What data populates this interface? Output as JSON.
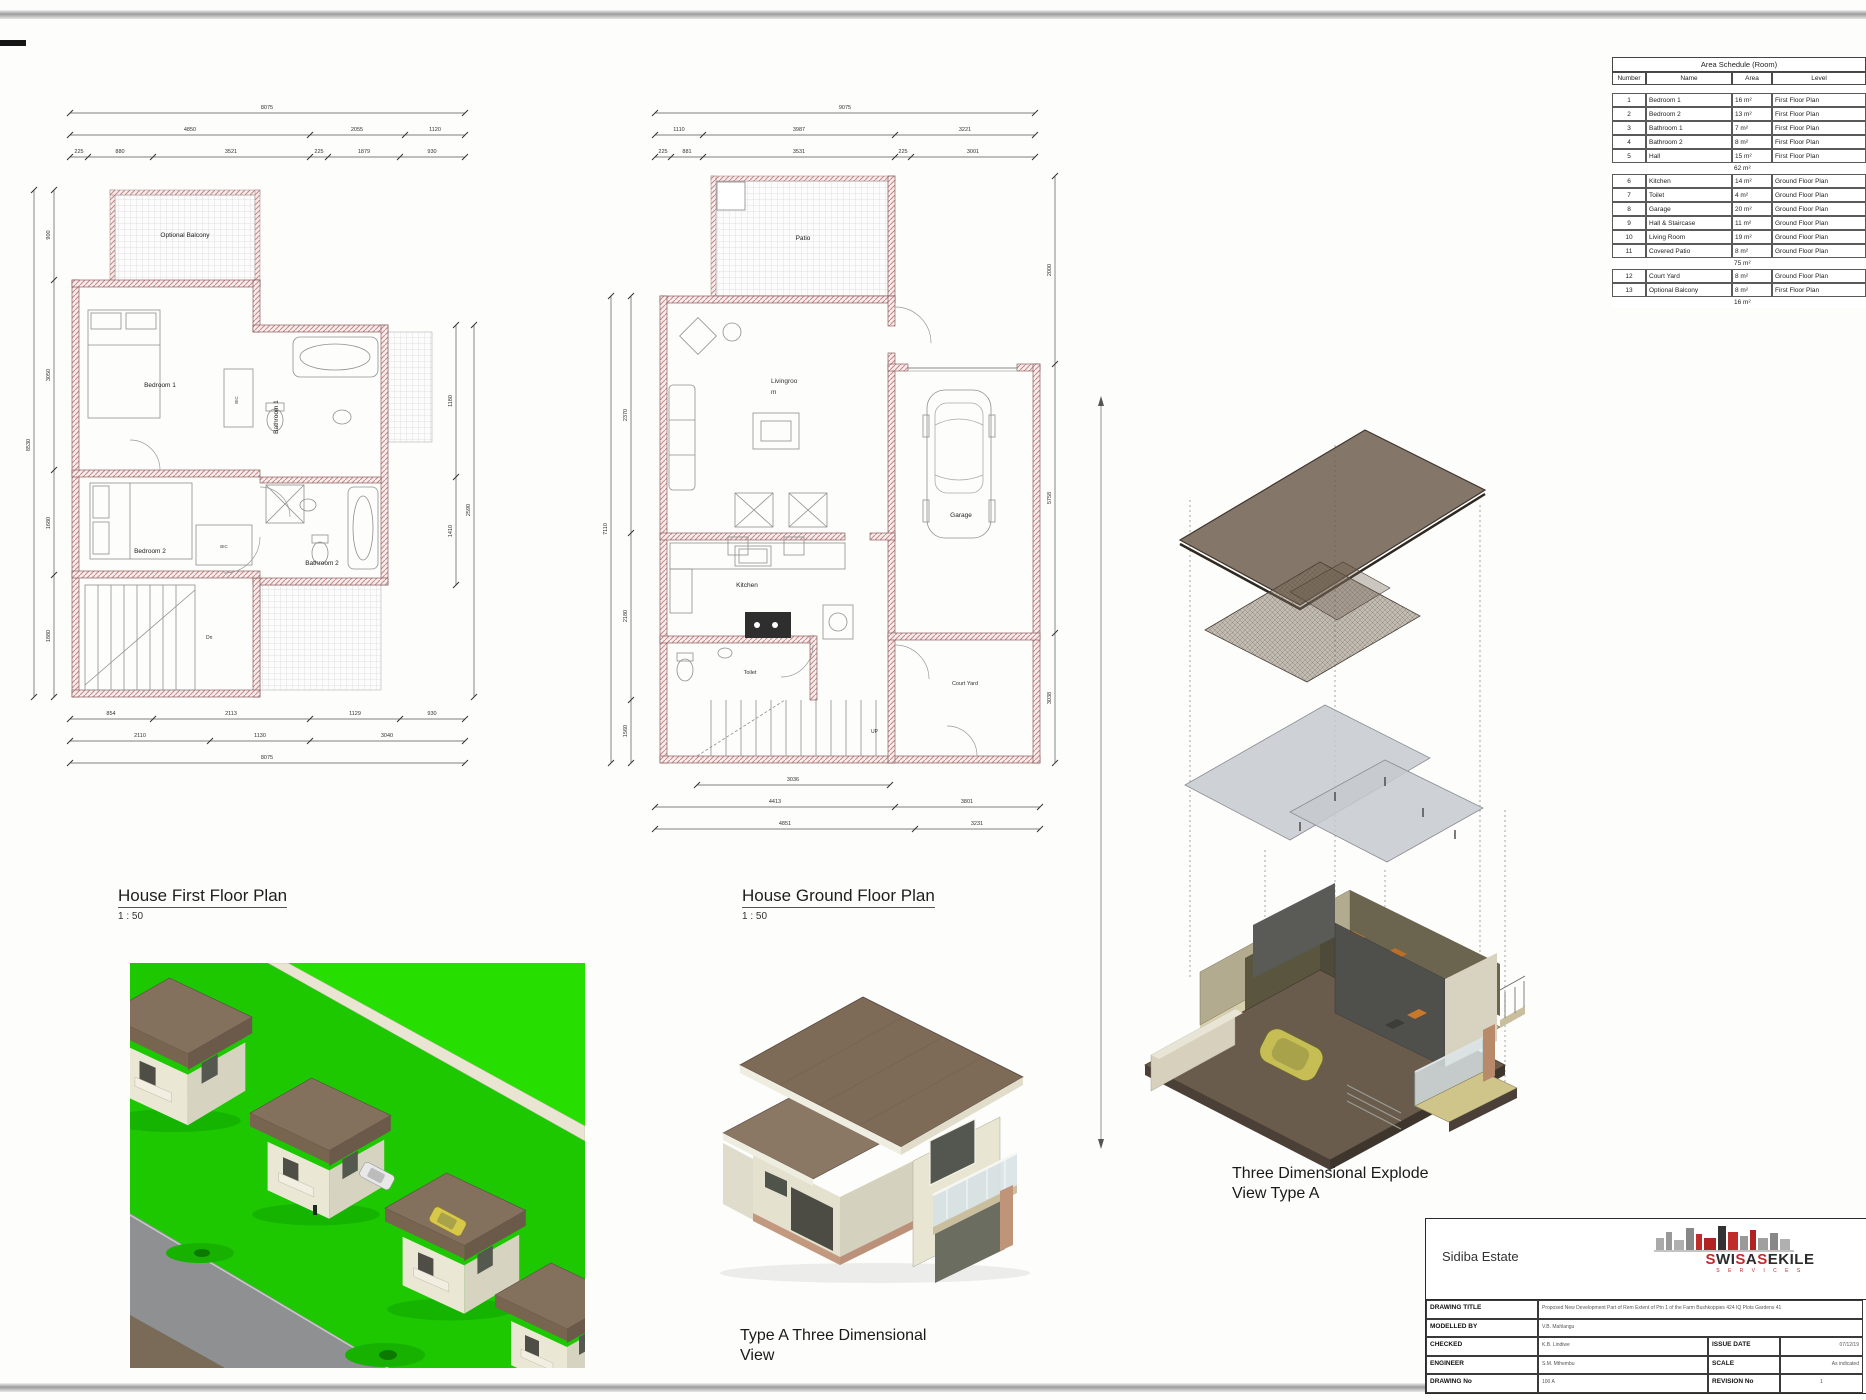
{
  "colors": {
    "logo_red": "#c02b2b",
    "logo_dark": "#2b2b2b",
    "grass_green": "#1ec800",
    "roof_brown": "#7d6b57",
    "wall_hatch_pink": "#c88a8a",
    "slab_gray": "#c6c9ce"
  },
  "area_schedule": {
    "title": "Area Schedule (Room)",
    "headers": [
      "Number",
      "Name",
      "Area",
      "Level"
    ],
    "rows": [
      {
        "no": "1",
        "name": "Bedroom 1",
        "area": "16 m²",
        "level": "First Floor Plan"
      },
      {
        "no": "2",
        "name": "Bedroom 2",
        "area": "13 m²",
        "level": "First Floor Plan"
      },
      {
        "no": "3",
        "name": "Bathroom 1",
        "area": "7 m²",
        "level": "First Floor Plan"
      },
      {
        "no": "4",
        "name": "Bathroom 2",
        "area": "8 m²",
        "level": "First Floor Plan"
      },
      {
        "no": "5",
        "name": "Hall",
        "area": "15 m²",
        "level": "First Floor Plan"
      },
      {
        "subtotal": "62 m²"
      },
      {
        "no": "6",
        "name": "Kitchen",
        "area": "14 m²",
        "level": "Ground Floor Plan"
      },
      {
        "no": "7",
        "name": "Toilet",
        "area": "4 m²",
        "level": "Ground Floor Plan"
      },
      {
        "no": "8",
        "name": "Garage",
        "area": "20 m²",
        "level": "Ground Floor Plan"
      },
      {
        "no": "9",
        "name": "Hall & Staircase",
        "area": "11 m²",
        "level": "Ground Floor Plan"
      },
      {
        "no": "10",
        "name": "Living Room",
        "area": "19 m²",
        "level": "Ground Floor Plan"
      },
      {
        "no": "11",
        "name": "Covered Patio",
        "area": "8 m²",
        "level": "Ground Floor Plan"
      },
      {
        "subtotal": "75 m²"
      },
      {
        "no": "12",
        "name": "Court Yard",
        "area": "8 m²",
        "level": "Ground Floor Plan"
      },
      {
        "no": "13",
        "name": "Optional Balcony",
        "area": "8 m²",
        "level": "First Floor Plan"
      },
      {
        "subtotal": "16 m²"
      }
    ]
  },
  "plans": {
    "first_floor": {
      "title": "House First Floor Plan",
      "scale": "1 : 50",
      "rooms": {
        "balcony": "Optional Balcony",
        "bedroom1": "Bedroom 1",
        "bathroom1": "Bathroom 1",
        "bedroom2": "Bedroom 2",
        "bathroom2": "Bathroom 2",
        "stairs_dn": "Dn",
        "bic": "BIC"
      },
      "dims": {
        "t1": [
          "8075"
        ],
        "t2": [
          "4850",
          "2055",
          "1120"
        ],
        "t3": [
          "225",
          "880",
          "3521",
          "225",
          "1879",
          "930"
        ],
        "b1": [
          "854",
          "2113",
          "1129",
          "930"
        ],
        "b2": [
          "2110",
          "1130",
          "3040"
        ],
        "b3": [
          "8075"
        ],
        "l1": [
          "8530"
        ],
        "l2": [
          "900",
          "3050",
          "1680",
          "1880"
        ],
        "r1": [
          "2590"
        ],
        "r2": [
          "1180",
          "1410"
        ]
      }
    },
    "ground_floor": {
      "title": "House Ground Floor Plan",
      "scale": "1 : 50",
      "rooms": {
        "patio": "Patio",
        "living_1": "Livingroo",
        "living_2": "m",
        "kitchen": "Kitchen",
        "toilet": "Toilet",
        "garage": "Garage",
        "court_yard": "Court Yard",
        "stairs_up": "UP"
      },
      "dims": {
        "t1": [
          "9075"
        ],
        "t2": [
          "1110",
          "3987",
          "3221"
        ],
        "t3": [
          "225",
          "881",
          "3531",
          "225",
          "3001"
        ],
        "b1": [
          "3036"
        ],
        "b2": [
          "4413",
          "3801"
        ],
        "b3": [
          "4851",
          "3231"
        ],
        "l1": [
          "7110"
        ],
        "l2": [
          "2370",
          "2180",
          "1560"
        ],
        "r1": [
          "2000",
          "5758",
          "3038"
        ]
      }
    }
  },
  "views": {
    "explode": {
      "line1": "Three Dimensional Explode",
      "line2": "View Type A"
    },
    "type_a": {
      "line1": "Type A Three Dimensional",
      "line2": "View"
    }
  },
  "title_block": {
    "project_name": "Sidiba Estate",
    "logo": {
      "letters": [
        [
          "S",
          "r"
        ],
        [
          "W",
          "d"
        ],
        [
          "I",
          "d"
        ],
        [
          "S",
          "r"
        ],
        [
          "A",
          "d"
        ],
        [
          "S",
          "r"
        ],
        [
          "E",
          "d"
        ],
        [
          "K",
          "d"
        ],
        [
          "I",
          "d"
        ],
        [
          "L",
          "d"
        ],
        [
          "E",
          "d"
        ]
      ],
      "tagline": "S E R V I C E S"
    },
    "fields": {
      "drawing_title_label": "DRAWING TITLE",
      "drawing_title": "Proposed New Development Part of Rem Extent of Ptn 1 of the Farm Bushkoppies 424 IQ Plots Gardens 41",
      "modelled_by_label": "MODELLED BY",
      "modelled_by": "V.B. Mahlangu",
      "checked_label": "CHECKED",
      "checked": "K.B. Lindiwe",
      "engineer_label": "ENGINEER",
      "engineer": "S.M. Mthembu",
      "drawing_no_label": "DRAWING No",
      "drawing_no": "100 A",
      "issue_date_label": "ISSUE DATE",
      "issue_date": "07/12/19",
      "scale_label": "SCALE",
      "scale": "As indicated",
      "revision_label": "REVISION No",
      "revision": "1"
    }
  }
}
